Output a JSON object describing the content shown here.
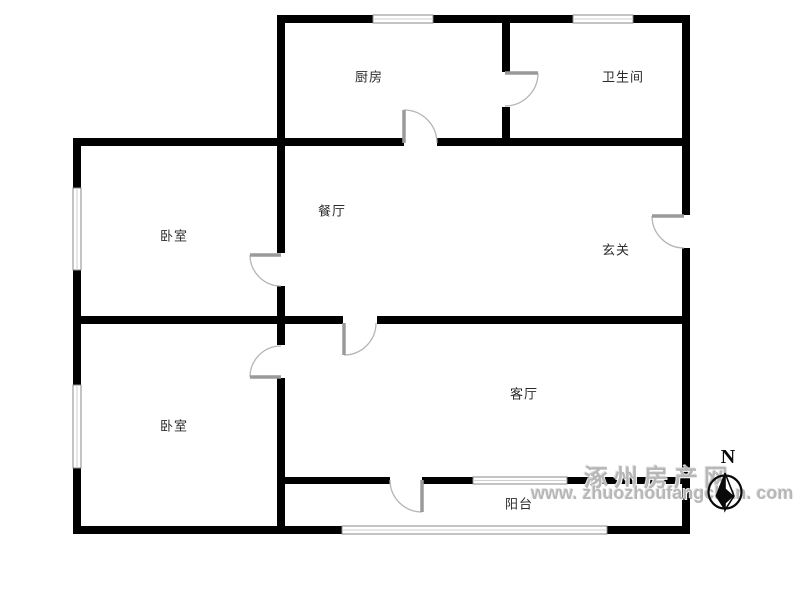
{
  "page": {
    "background": "#ffffff"
  },
  "rooms": [
    {
      "name": "kitchen",
      "label": "厨房",
      "cx": 369,
      "cy": 76
    },
    {
      "name": "bathroom",
      "label": "卫生间",
      "cx": 623,
      "cy": 76
    },
    {
      "name": "dining",
      "label": "餐厅",
      "cx": 332,
      "cy": 210
    },
    {
      "name": "hall",
      "label": "玄关",
      "cx": 616,
      "cy": 249
    },
    {
      "name": "bedroom-top",
      "label": "卧室",
      "cx": 174,
      "cy": 235
    },
    {
      "name": "bedroom-bottom",
      "label": "卧室",
      "cx": 174,
      "cy": 425
    },
    {
      "name": "living",
      "label": "客厅",
      "cx": 524,
      "cy": 393
    },
    {
      "name": "balcony",
      "label": "阳台",
      "cx": 519,
      "cy": 503
    }
  ],
  "floorplan": {
    "wall_color": "#000000",
    "door_leaf_color": "#9a9a9a",
    "door_arc_color": "#b5b5b5",
    "window_edge_color": "#8a8a8a",
    "window_inner_color": "#cfcfcf",
    "walls": [
      [
        277,
        15,
        413,
        8
      ],
      [
        73,
        138,
        331,
        8
      ],
      [
        437,
        138,
        253,
        8
      ],
      [
        73,
        316,
        270,
        8
      ],
      [
        377,
        316,
        313,
        8
      ],
      [
        277,
        477,
        113,
        7
      ],
      [
        422,
        477,
        51,
        7
      ],
      [
        567,
        477,
        123,
        7
      ],
      [
        73,
        526,
        269,
        8
      ],
      [
        607,
        526,
        83,
        8
      ],
      [
        73,
        138,
        8,
        50
      ],
      [
        73,
        270,
        8,
        115
      ],
      [
        73,
        468,
        8,
        66
      ],
      [
        277,
        15,
        8,
        238
      ],
      [
        277,
        286,
        8,
        59
      ],
      [
        277,
        378,
        8,
        156
      ],
      [
        502,
        15,
        8,
        57
      ],
      [
        502,
        107,
        8,
        31
      ],
      [
        682,
        15,
        8,
        200
      ],
      [
        682,
        248,
        8,
        286
      ]
    ],
    "windows": [
      {
        "name": "kitchen-window",
        "x": 373,
        "y": 15,
        "w": 60,
        "h": 8
      },
      {
        "name": "bathroom-window",
        "x": 573,
        "y": 15,
        "w": 60,
        "h": 8
      },
      {
        "name": "bedroom-top-window",
        "x": 73,
        "y": 188,
        "w": 8,
        "h": 82
      },
      {
        "name": "bedroom-bottom-window",
        "x": 73,
        "y": 385,
        "w": 8,
        "h": 83
      },
      {
        "name": "living-balcony-window",
        "x": 473,
        "y": 477,
        "w": 94,
        "h": 7
      },
      {
        "name": "balcony-window",
        "x": 342,
        "y": 526,
        "w": 265,
        "h": 8
      }
    ],
    "doors": [
      {
        "name": "kitchen-door",
        "hx": 404,
        "hy": 143,
        "r": 33,
        "leaf_deg": 270,
        "open_deg": 0
      },
      {
        "name": "bathroom-door",
        "hx": 505,
        "hy": 73,
        "r": 33,
        "leaf_deg": 0,
        "open_deg": 90
      },
      {
        "name": "bedroom-top-door",
        "hx": 281,
        "hy": 255,
        "r": 31,
        "leaf_deg": 180,
        "open_deg": 90
      },
      {
        "name": "entry-door",
        "hx": 684,
        "hy": 216,
        "r": 32,
        "leaf_deg": 180,
        "open_deg": 90
      },
      {
        "name": "living-door",
        "hx": 344,
        "hy": 323,
        "r": 32,
        "leaf_deg": 90,
        "open_deg": 0
      },
      {
        "name": "bedroom-bottom-door",
        "hx": 281,
        "hy": 377,
        "r": 31,
        "leaf_deg": 180,
        "open_deg": 270
      },
      {
        "name": "balcony-door",
        "hx": 422,
        "hy": 480,
        "r": 32,
        "leaf_deg": 90,
        "open_deg": 180
      }
    ]
  },
  "watermark": {
    "line1": "涿州房产网",
    "line2": "www. zhuozhoufangchan. com"
  },
  "compass": {
    "label": "N"
  }
}
